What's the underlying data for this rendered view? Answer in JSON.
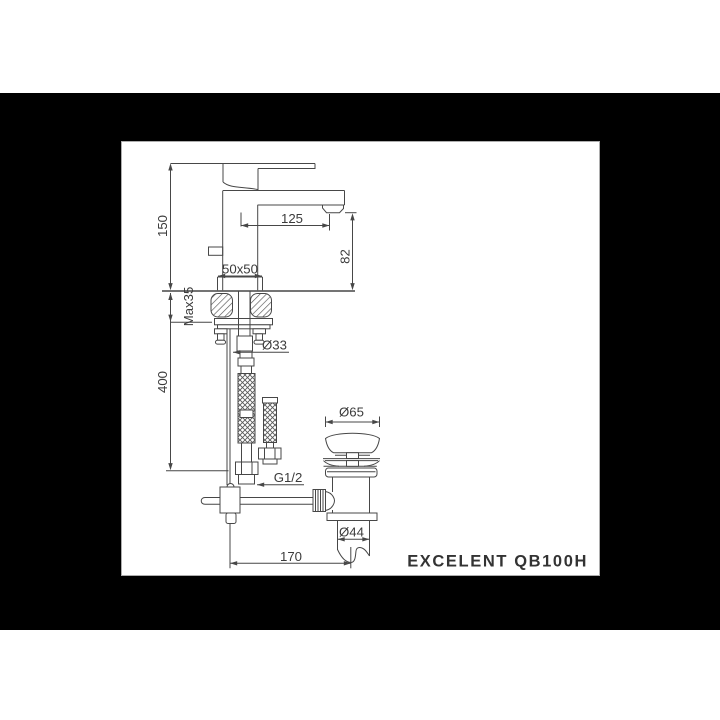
{
  "drawing_labels": {
    "dim_150": "150",
    "dim_125": "125",
    "dim_82": "82",
    "dim_50x50": "50x50",
    "dim_max35": "Max35",
    "dim_400": "400",
    "dim_o33": "Ø33",
    "dim_g12": "G1/2",
    "dim_o65": "Ø65",
    "dim_o44": "Ø44",
    "dim_170": "170"
  },
  "brand": {
    "model_text": "EXCELENT QB100H"
  },
  "colors": {
    "backdrop": "#000000",
    "paper": "#ffffff",
    "line_color": "#474747",
    "dimension_text": "#3b3b3b",
    "logo_text": "#333333"
  }
}
